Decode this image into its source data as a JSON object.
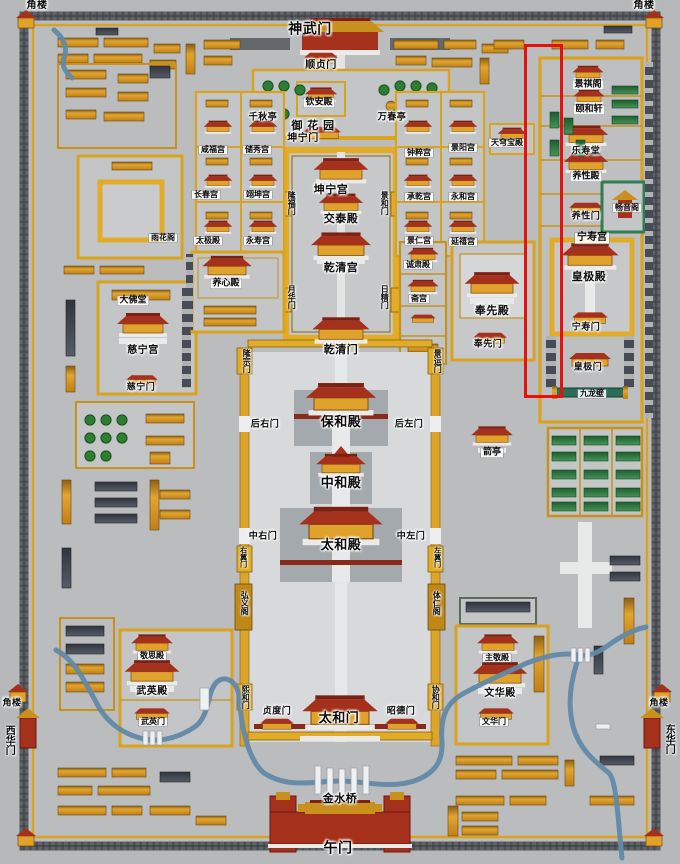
{
  "map": {
    "annotation": {
      "x": 524,
      "y": 44,
      "width": 33,
      "height": 348,
      "color": "#e8100c"
    },
    "palette": {
      "ground": "#b6b8ba",
      "wall_gold": "#d9a31f",
      "building_orange": "#d9952c",
      "hall_roof_red": "#a5301c",
      "river_blue": "#6189a9",
      "garden_green": "#2e7d34"
    },
    "labels": [
      {
        "t": "角楼",
        "x": 37,
        "y": 6,
        "st": "p",
        "fs": 10
      },
      {
        "t": "神武门",
        "x": 310,
        "y": 30,
        "st": "p",
        "fs": 14
      },
      {
        "t": "角楼",
        "x": 644,
        "y": 6,
        "st": "p",
        "fs": 10
      },
      {
        "t": "顺贞门",
        "x": 321,
        "y": 66,
        "st": "p",
        "fs": 10
      },
      {
        "t": "钦安殿",
        "x": 319,
        "y": 103,
        "st": "b",
        "fs": 9
      },
      {
        "t": "千秋亭",
        "x": 263,
        "y": 118,
        "st": "p",
        "fs": 9
      },
      {
        "t": "万春亭",
        "x": 392,
        "y": 118,
        "st": "p",
        "fs": 9
      },
      {
        "t": "御 花 园",
        "x": 313,
        "y": 126,
        "st": "p",
        "fs": 11
      },
      {
        "t": "坤宁门",
        "x": 303,
        "y": 139,
        "st": "p",
        "fs": 10
      },
      {
        "t": "天穹宝殿",
        "x": 507,
        "y": 143,
        "st": "b",
        "fs": 8
      },
      {
        "t": "景祺阁",
        "x": 588,
        "y": 85,
        "st": "b",
        "fs": 9
      },
      {
        "t": "颐和轩",
        "x": 589,
        "y": 110,
        "st": "b",
        "fs": 9
      },
      {
        "t": "乐寿堂",
        "x": 586,
        "y": 152,
        "st": "p",
        "fs": 9
      },
      {
        "t": "养性殿",
        "x": 586,
        "y": 177,
        "st": "b",
        "fs": 9
      },
      {
        "t": "畅音阁",
        "x": 627,
        "y": 208,
        "st": "b",
        "fs": 8
      },
      {
        "t": "养性门",
        "x": 586,
        "y": 217,
        "st": "p",
        "fs": 9
      },
      {
        "t": "宁寿宫",
        "x": 592,
        "y": 238,
        "st": "b",
        "fs": 10
      },
      {
        "t": "皇极殿",
        "x": 589,
        "y": 277,
        "st": "p",
        "fs": 11
      },
      {
        "t": "宁寿门",
        "x": 586,
        "y": 328,
        "st": "p",
        "fs": 9
      },
      {
        "t": "皇极门",
        "x": 588,
        "y": 368,
        "st": "p",
        "fs": 9
      },
      {
        "t": "九龙壁",
        "x": 592,
        "y": 394,
        "st": "b",
        "fs": 8
      },
      {
        "t": "咸福宫",
        "x": 213,
        "y": 150,
        "st": "b",
        "fs": 8
      },
      {
        "t": "储秀宫",
        "x": 257,
        "y": 150,
        "st": "b",
        "fs": 8
      },
      {
        "t": "长春宫",
        "x": 206,
        "y": 195,
        "st": "b",
        "fs": 8
      },
      {
        "t": "翊坤宫",
        "x": 258,
        "y": 195,
        "st": "b",
        "fs": 8
      },
      {
        "t": "太极殿",
        "x": 208,
        "y": 241,
        "st": "b",
        "fs": 8
      },
      {
        "t": "永寿宫",
        "x": 258,
        "y": 241,
        "st": "b",
        "fs": 8
      },
      {
        "t": "雨花阁",
        "x": 163,
        "y": 238,
        "st": "b",
        "fs": 8
      },
      {
        "t": "钟粹宫",
        "x": 419,
        "y": 153,
        "st": "b",
        "fs": 8
      },
      {
        "t": "景阳宫",
        "x": 463,
        "y": 148,
        "st": "b",
        "fs": 8
      },
      {
        "t": "承乾宫",
        "x": 419,
        "y": 197,
        "st": "b",
        "fs": 8
      },
      {
        "t": "永和宫",
        "x": 463,
        "y": 197,
        "st": "b",
        "fs": 8
      },
      {
        "t": "景仁宫",
        "x": 419,
        "y": 241,
        "st": "b",
        "fs": 8
      },
      {
        "t": "延禧宫",
        "x": 463,
        "y": 242,
        "st": "b",
        "fs": 8
      },
      {
        "t": "坤宁宫",
        "x": 331,
        "y": 190,
        "st": "p",
        "fs": 11
      },
      {
        "t": "交泰殿",
        "x": 341,
        "y": 219,
        "st": "p",
        "fs": 11
      },
      {
        "t": "乾清宫",
        "x": 341,
        "y": 268,
        "st": "p",
        "fs": 11
      },
      {
        "t": "隆福门",
        "x": 291,
        "y": 203,
        "st": "v",
        "fs": 8
      },
      {
        "t": "景和门",
        "x": 384,
        "y": 203,
        "st": "v",
        "fs": 8
      },
      {
        "t": "月华门",
        "x": 291,
        "y": 297,
        "st": "v",
        "fs": 8
      },
      {
        "t": "日精门",
        "x": 384,
        "y": 297,
        "st": "v",
        "fs": 8
      },
      {
        "t": "养心殿",
        "x": 226,
        "y": 284,
        "st": "b",
        "fs": 9
      },
      {
        "t": "诚肃殿",
        "x": 418,
        "y": 265,
        "st": "b",
        "fs": 8
      },
      {
        "t": "斋宫",
        "x": 419,
        "y": 299,
        "st": "b",
        "fs": 8
      },
      {
        "t": "奉先殿",
        "x": 492,
        "y": 311,
        "st": "p",
        "fs": 11
      },
      {
        "t": "奉先门",
        "x": 488,
        "y": 345,
        "st": "p",
        "fs": 9
      },
      {
        "t": "大佛堂",
        "x": 133,
        "y": 301,
        "st": "b",
        "fs": 9
      },
      {
        "t": "慈宁宫",
        "x": 143,
        "y": 351,
        "st": "p",
        "fs": 10
      },
      {
        "t": "慈宁门",
        "x": 141,
        "y": 388,
        "st": "p",
        "fs": 9
      },
      {
        "t": "隆宗门",
        "x": 246,
        "y": 361,
        "st": "v",
        "fs": 8
      },
      {
        "t": "景运门",
        "x": 437,
        "y": 361,
        "st": "v",
        "fs": 8
      },
      {
        "t": "乾清门",
        "x": 341,
        "y": 350,
        "st": "p",
        "fs": 11
      },
      {
        "t": "保和殿",
        "x": 341,
        "y": 423,
        "st": "p",
        "fs": 13
      },
      {
        "t": "后右门",
        "x": 265,
        "y": 425,
        "st": "p",
        "fs": 9
      },
      {
        "t": "后左门",
        "x": 409,
        "y": 425,
        "st": "p",
        "fs": 9
      },
      {
        "t": "中和殿",
        "x": 341,
        "y": 484,
        "st": "p",
        "fs": 13
      },
      {
        "t": "太和殿",
        "x": 341,
        "y": 546,
        "st": "p",
        "fs": 13
      },
      {
        "t": "中右门",
        "x": 263,
        "y": 537,
        "st": "p",
        "fs": 9
      },
      {
        "t": "中左门",
        "x": 411,
        "y": 537,
        "st": "p",
        "fs": 9
      },
      {
        "t": "右翼门",
        "x": 243,
        "y": 557,
        "st": "v",
        "fs": 7
      },
      {
        "t": "左翼门",
        "x": 437,
        "y": 557,
        "st": "v",
        "fs": 7
      },
      {
        "t": "弘义阁",
        "x": 244,
        "y": 603,
        "st": "v",
        "fs": 8
      },
      {
        "t": "体仁阁",
        "x": 436,
        "y": 603,
        "st": "v",
        "fs": 8
      },
      {
        "t": "箭亭",
        "x": 492,
        "y": 453,
        "st": "b",
        "fs": 9
      },
      {
        "t": "敬思殿",
        "x": 152,
        "y": 656,
        "st": "b",
        "fs": 8
      },
      {
        "t": "武英殿",
        "x": 152,
        "y": 692,
        "st": "p",
        "fs": 10
      },
      {
        "t": "武英门",
        "x": 153,
        "y": 722,
        "st": "b",
        "fs": 8
      },
      {
        "t": "主敬殿",
        "x": 497,
        "y": 658,
        "st": "b",
        "fs": 8
      },
      {
        "t": "文华殿",
        "x": 500,
        "y": 694,
        "st": "p",
        "fs": 10
      },
      {
        "t": "文华门",
        "x": 494,
        "y": 722,
        "st": "b",
        "fs": 8
      },
      {
        "t": "熙和门",
        "x": 245,
        "y": 697,
        "st": "v",
        "fs": 8
      },
      {
        "t": "协和门",
        "x": 435,
        "y": 697,
        "st": "v",
        "fs": 8
      },
      {
        "t": "贞度门",
        "x": 277,
        "y": 712,
        "st": "p",
        "fs": 9
      },
      {
        "t": "太和门",
        "x": 339,
        "y": 719,
        "st": "p",
        "fs": 13
      },
      {
        "t": "昭德门",
        "x": 401,
        "y": 712,
        "st": "p",
        "fs": 9
      },
      {
        "t": "金水桥",
        "x": 340,
        "y": 799,
        "st": "p",
        "fs": 11
      },
      {
        "t": "午门",
        "x": 338,
        "y": 849,
        "st": "p",
        "fs": 14
      },
      {
        "t": "角楼",
        "x": 12,
        "y": 704,
        "st": "p",
        "fs": 9
      },
      {
        "t": "西华门",
        "x": 8,
        "y": 740,
        "st": "v",
        "fs": 10
      },
      {
        "t": "角楼",
        "x": 659,
        "y": 704,
        "st": "p",
        "fs": 9
      },
      {
        "t": "东华门",
        "x": 668,
        "y": 739,
        "st": "v",
        "fs": 10
      }
    ]
  }
}
